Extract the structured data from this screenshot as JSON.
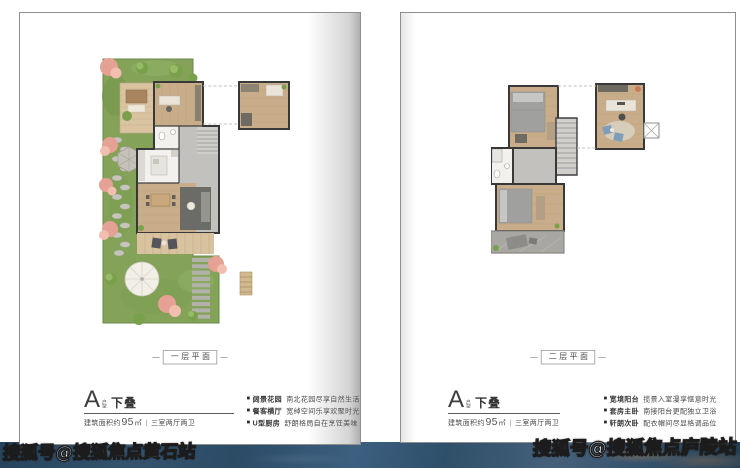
{
  "colors": {
    "garden-green": "#84a258",
    "wood": "#c9ad8a",
    "tile-gray": "#c2c1be",
    "wall": "#383838",
    "tree-pink": "#e5a193",
    "strip-blue": "#35536e",
    "strip-blue-dark": "#27435c",
    "page-border": "#8e8e8e"
  },
  "watermarks": {
    "bottom_left": "搜狐号@搜狐焦点黄石站",
    "bottom_right": "搜狐号@搜狐焦点庐陵站"
  },
  "left_page": {
    "floor_label": "一层平面",
    "unit": {
      "prefix": "A",
      "small_top": "户",
      "small_bottom": "型",
      "suffix": "下叠"
    },
    "area": {
      "prefix": "建筑面积约",
      "value": "95",
      "unit": "㎡",
      "divider": "|",
      "layout": "三室两厅两卫"
    },
    "bullets": [
      {
        "head": "阔景花园",
        "body": "南北花园尽享自然生活"
      },
      {
        "head": "餐客横厅",
        "body": "宽绰空间乐享欢聚时光"
      },
      {
        "head": "U型厨房",
        "body": "舒朗格局自在烹饪美味"
      }
    ]
  },
  "right_page": {
    "floor_label": "二层平面",
    "unit": {
      "prefix": "A",
      "small_top": "户",
      "small_bottom": "型",
      "suffix": "下叠"
    },
    "area": {
      "prefix": "建筑面积约",
      "value": "95",
      "unit": "㎡",
      "divider": "|",
      "layout": "三室两厅两卫"
    },
    "bullets": [
      {
        "head": "宽境阳台",
        "body": "揽景入室漫享惬意时光"
      },
      {
        "head": "套房主卧",
        "body": "南接阳台更配独立卫浴"
      },
      {
        "head": "轩朗次卧",
        "body": "配衣帽间尽显格调品位"
      }
    ]
  }
}
